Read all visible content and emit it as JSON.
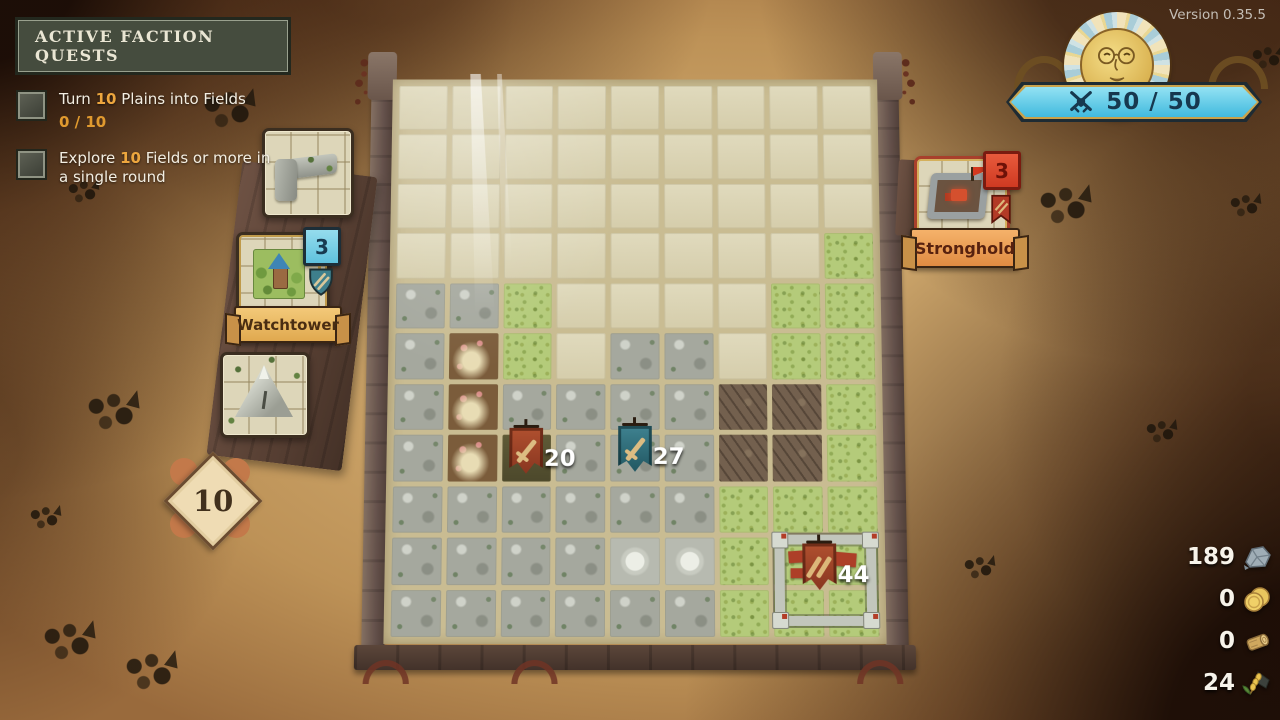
{
  "version_label": "Version 0.35.5",
  "quest_panel": {
    "title": "ACTIVE FACTION QUESTS",
    "items": [
      {
        "pre": "Turn ",
        "num": "10",
        "post": " Plains into Fields",
        "progress": "0 / 10"
      },
      {
        "pre": "Explore ",
        "num": "10",
        "post": " Fields or more in a single round",
        "progress": ""
      }
    ]
  },
  "hand_dock": {
    "tiles_remaining": "10",
    "cards": [
      {
        "label": "",
        "type": "rock-corner-tile"
      },
      {
        "label": "Watchtower",
        "count": "3",
        "type": "watchtower"
      },
      {
        "label": "",
        "type": "mountain-tile"
      }
    ]
  },
  "enemy_card": {
    "label": "Stronghold",
    "count": "3"
  },
  "war_banner": {
    "value": "50 / 50",
    "icon": "crossed-swords-icon"
  },
  "board": {
    "banners": [
      {
        "value": "20",
        "color": "red"
      },
      {
        "value": "27",
        "color": "teal"
      },
      {
        "value": "44",
        "color": "red",
        "location": "fortress"
      }
    ],
    "grid": {
      "cols": 9,
      "rows": 11,
      "legend": {
        "E": "empty-plains",
        "G": "grass",
        "R": "rock",
        "B": "battlefield",
        "F": "farm-field",
        "D": "dark-field",
        "M": "crater"
      },
      "tiles": [
        "EEEEEEEEE",
        "EEEEEEEEE",
        "EEEEEEEEE",
        "EEEEEEEEG",
        "RRGEEEEGG",
        "RFGERREGG",
        "RFRRRRBBG",
        "RFDRRRBBG",
        "RRRRRRGGG",
        "RRRRMMGGG",
        "RRRRRRGGG"
      ]
    }
  },
  "resources": [
    {
      "name": "stone",
      "value": "189",
      "icon": "stone-icon"
    },
    {
      "name": "gold",
      "value": "0",
      "icon": "coins-icon"
    },
    {
      "name": "wood",
      "value": "0",
      "icon": "log-icon"
    },
    {
      "name": "wheat",
      "value": "24",
      "icon": "wheat-icon"
    }
  ],
  "colors": {
    "war_banner_blue": "#5ecbe8",
    "badge_blue": "#7fd2e8",
    "badge_red": "#e0472f",
    "quest_number_gold": "#eda63e",
    "card_label_orange": "#efae58",
    "board_plains": "#dbd5b5",
    "board_grass": "#b4cb7a"
  }
}
